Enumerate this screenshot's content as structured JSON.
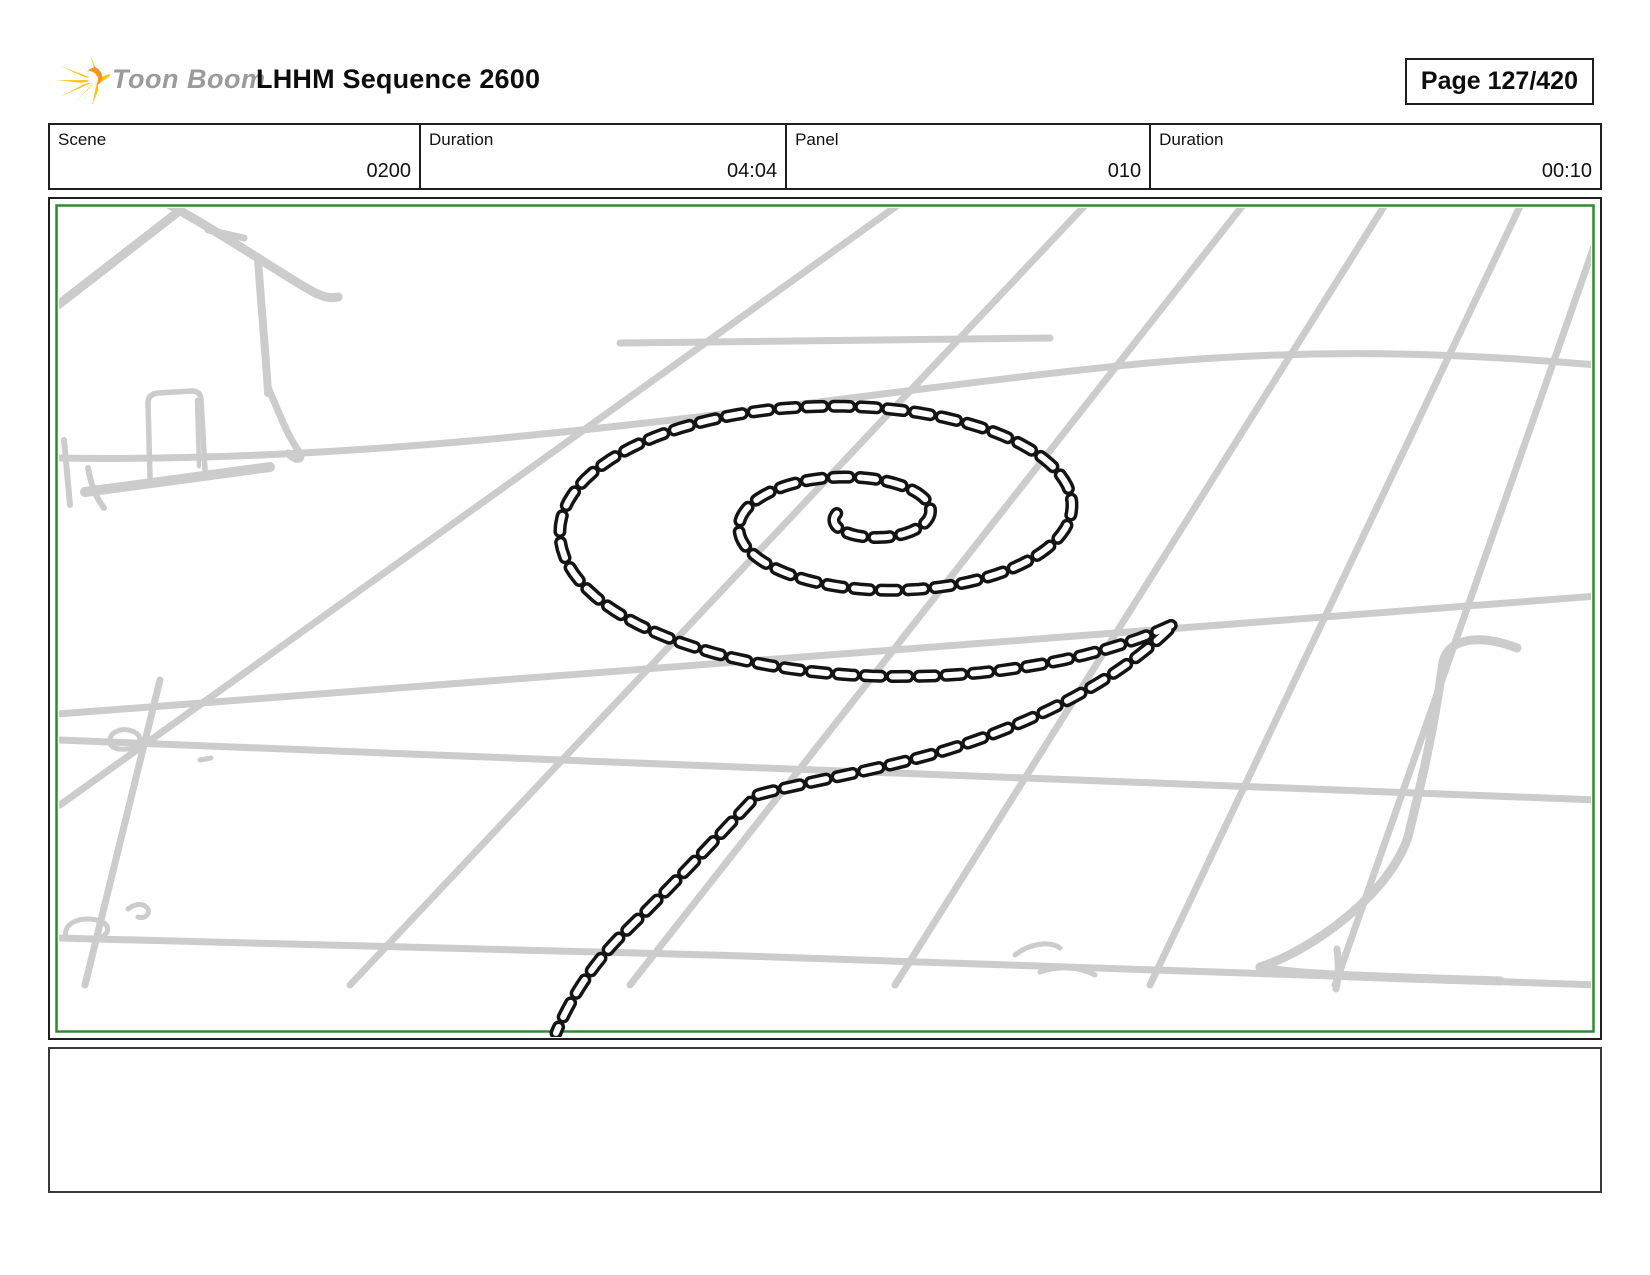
{
  "header": {
    "logo_text": "Toon Boom",
    "title": "LHHM Sequence 2600",
    "page_label": "Page 127/420"
  },
  "info_table": {
    "cells": [
      {
        "label": "Scene",
        "value": "0200"
      },
      {
        "label": "Duration",
        "value": "04:04"
      },
      {
        "label": "Panel",
        "value": "010"
      },
      {
        "label": "Duration",
        "value": "00:10"
      }
    ]
  },
  "panel": {
    "frame_color": "#2e8b2e",
    "sketch_color": "#cccccc",
    "rope_color": "#141414",
    "paper_color": "#ffffff"
  },
  "logo_colors": {
    "ray_yellow": "#FFC20E",
    "core_orange": "#F7941E"
  },
  "comment_box": {
    "content": ""
  }
}
